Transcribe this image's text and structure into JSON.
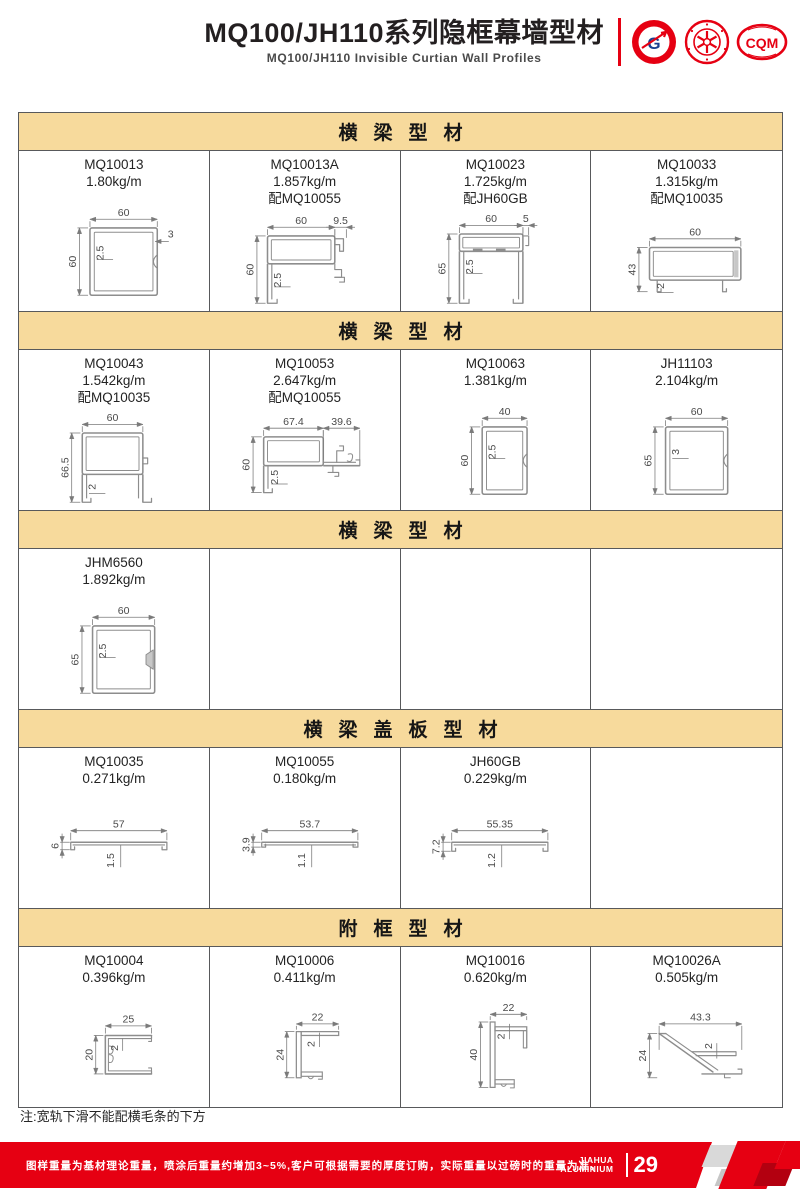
{
  "header": {
    "title": "MQ100/JH110系列隐框幕墙型材",
    "subtitle": "MQ100/JH110  Invisible  Curtian  Wall  Profiles",
    "logos": [
      "gb-certification-logo",
      "star-certification-seal",
      "cqm-certification-logo"
    ]
  },
  "colors": {
    "band_bg": "#f7da9c",
    "accent_red": "#e60012",
    "table_border": "#58595b",
    "drawing_line": "#8d8d8d",
    "dim_text": "#4a4a4a"
  },
  "sections": [
    {
      "title": "横梁型材",
      "cells": [
        {
          "code": "MQ10013",
          "weight": "1.80kg/m",
          "match": "",
          "shape": "tube-notch",
          "top": "60",
          "left": "60",
          "wall": "2.5",
          "extra": "3"
        },
        {
          "code": "MQ10013A",
          "weight": "1.857kg/m",
          "match": "配MQ10055",
          "shape": "hook",
          "top": "60",
          "top2": "9.5",
          "left": "60",
          "wall": "2.5"
        },
        {
          "code": "MQ10023",
          "weight": "1.725kg/m",
          "match": "配JH60GB",
          "shape": "u-legs",
          "top": "60",
          "top2": "5",
          "left": "65",
          "wall": "2.5"
        },
        {
          "code": "MQ10033",
          "weight": "1.315kg/m",
          "match": "配MQ10035",
          "shape": "low-box",
          "top": "60",
          "left": "43",
          "wall": "2"
        }
      ]
    },
    {
      "title": "横梁型材",
      "cells": [
        {
          "code": "MQ10043",
          "weight": "1.542kg/m",
          "match": "配MQ10035",
          "shape": "box-legs",
          "top": "60",
          "left": "66.5",
          "wall": "2"
        },
        {
          "code": "MQ10053",
          "weight": "2.647kg/m",
          "match": "配MQ10055",
          "shape": "box-ext",
          "top": "67.4",
          "top2": "39.6",
          "left": "60",
          "wall": "2.5"
        },
        {
          "code": "MQ10063",
          "weight": "1.381kg/m",
          "match": "",
          "shape": "tube-notch",
          "top": "40",
          "left": "60",
          "wall": "2.5"
        },
        {
          "code": "JH11103",
          "weight": "2.104kg/m",
          "match": "",
          "shape": "tube-notch",
          "top": "60",
          "left": "65",
          "wall": "3"
        }
      ]
    },
    {
      "title": "横梁型材",
      "cells": [
        {
          "code": "JHM6560",
          "weight": "1.892kg/m",
          "match": "",
          "shape": "tube-wedge",
          "top": "60",
          "left": "65",
          "wall": "2.5"
        },
        null,
        null,
        null
      ]
    },
    {
      "title": "横梁盖板型材",
      "cells": [
        {
          "code": "MQ10035",
          "weight": "0.271kg/m",
          "match": "",
          "shape": "plate",
          "top": "57",
          "left": "6",
          "wall": "1.5"
        },
        {
          "code": "MQ10055",
          "weight": "0.180kg/m",
          "match": "",
          "shape": "plate",
          "top": "53.7",
          "left": "3.9",
          "wall": "1.1"
        },
        {
          "code": "JH60GB",
          "weight": "0.229kg/m",
          "match": "",
          "shape": "plate",
          "top": "55.35",
          "left": "7.2",
          "wall": "1.2"
        },
        null
      ]
    },
    {
      "title": "附框型材",
      "cells": [
        {
          "code": "MQ10004",
          "weight": "0.396kg/m",
          "match": "",
          "shape": "c-channel",
          "top": "25",
          "left": "20",
          "wall": "2"
        },
        {
          "code": "MQ10006",
          "weight": "0.411kg/m",
          "match": "",
          "shape": "f-profile",
          "top": "22",
          "left": "24",
          "wall": "2"
        },
        {
          "code": "MQ10016",
          "weight": "0.620kg/m",
          "match": "",
          "shape": "tall-f",
          "top": "22",
          "left": "40",
          "wall": "2"
        },
        {
          "code": "MQ10026A",
          "weight": "0.505kg/m",
          "match": "",
          "shape": "diagonal",
          "top": "43.3",
          "left": "24",
          "wall": "2"
        }
      ]
    }
  ],
  "note": "注:宽轨下滑不能配横毛条的下方",
  "footer": {
    "text": "图样重量为基材理论重量，喷涂后重量约增加3~5%,客户可根据需要的厚度订购，实际重量以过磅时的重量为准。",
    "brand_line1": "JIAHUA",
    "brand_line2": "ALUMINIUM",
    "page": "29"
  }
}
